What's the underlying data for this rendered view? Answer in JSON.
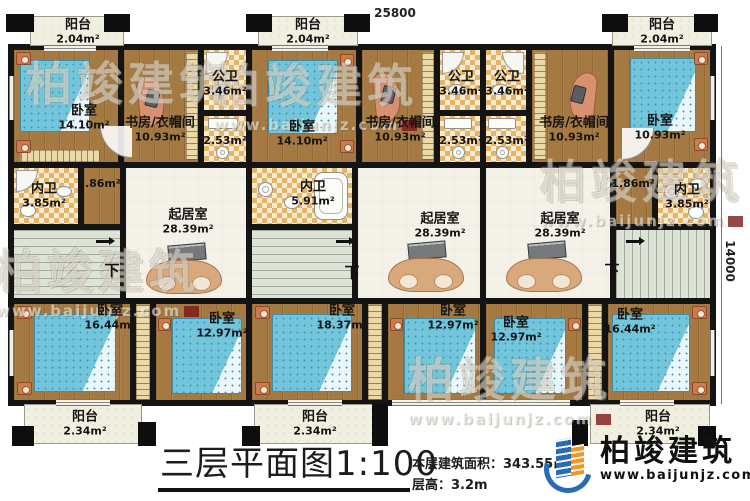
{
  "title_block": {
    "title": "三层平面图1:100",
    "area_label": "本层建筑面积：",
    "area_value": "343.55㎡",
    "height_label": "层高：",
    "height_value": "3.2m"
  },
  "logo": {
    "name": "柏竣建筑",
    "url": "www.baijunjz.com"
  },
  "watermark": {
    "text": "柏竣建筑",
    "url": "www.baijunjz.com"
  },
  "dimensions": {
    "top": {
      "text": "25800",
      "xy": [
        365,
        6
      ]
    },
    "right": {
      "text": "14000",
      "xy": [
        700,
        254
      ]
    }
  },
  "stairs_label": "下",
  "colors": {
    "wall": "#141414",
    "wood": "#a57a42",
    "bath_dark": "#e5b469",
    "bath_light": "#f6ecd2",
    "living": "#f4f2e8",
    "stair": "#dde3d7",
    "balcony": "#f1efe0",
    "bed": "#72c5da",
    "accent_blue": "#2a6cb4",
    "accent_orange": "#f7941d"
  },
  "main_block": [
    8,
    44,
    708,
    362
  ],
  "rooms": [
    {
      "name": "阳台",
      "area": "2.04m²",
      "rect": [
        30,
        16,
        94,
        30
      ],
      "type": "balcony",
      "label": [
        78,
        32
      ]
    },
    {
      "name": "阳台",
      "area": "2.04m²",
      "rect": [
        258,
        16,
        100,
        30
      ],
      "type": "balcony",
      "label": [
        308,
        32
      ]
    },
    {
      "name": "阳台",
      "area": "2.04m²",
      "rect": [
        612,
        16,
        100,
        30
      ],
      "type": "balcony",
      "label": [
        662,
        32
      ]
    },
    {
      "name": "卧室",
      "area": "14.10m²",
      "rect": [
        14,
        50,
        104,
        112
      ],
      "type": "wood",
      "label": [
        84,
        118
      ]
    },
    {
      "name": "书房/衣帽间",
      "area": "10.93m²",
      "rect": [
        124,
        50,
        74,
        112
      ],
      "type": "wood",
      "label": [
        160,
        130
      ]
    },
    {
      "name": "公卫",
      "area": "3.46m²",
      "rect": [
        204,
        50,
        42,
        60
      ],
      "type": "bath",
      "label": [
        225,
        84
      ]
    },
    {
      "name": "",
      "area": "2.53m²",
      "rect": [
        204,
        116,
        42,
        46
      ],
      "type": "bath",
      "label": [
        225,
        141
      ]
    },
    {
      "name": "内卫",
      "area": "3.85m²",
      "rect": [
        14,
        168,
        64,
        56
      ],
      "type": "bath",
      "label": [
        44,
        196
      ]
    },
    {
      "name": "",
      "area": "1.86m²",
      "rect": [
        84,
        168,
        36,
        56
      ],
      "type": "wood",
      "label": [
        99,
        184
      ]
    },
    {
      "name": "",
      "area": "",
      "rect": [
        14,
        230,
        106,
        68
      ],
      "type": "stair"
    },
    {
      "name": "起居室",
      "area": "28.39m²",
      "rect": [
        126,
        168,
        120,
        130
      ],
      "type": "living",
      "label": [
        188,
        222
      ]
    },
    {
      "name": "卧室",
      "area": "16.44m²",
      "rect": [
        14,
        304,
        116,
        96
      ],
      "type": "wood",
      "label": [
        110,
        318
      ]
    },
    {
      "name": "",
      "area": "",
      "rect": [
        136,
        304,
        14,
        96
      ],
      "type": "closet"
    },
    {
      "name": "卧室",
      "area": "12.97m²",
      "rect": [
        156,
        304,
        90,
        96
      ],
      "type": "wood",
      "label": [
        222,
        326
      ]
    },
    {
      "name": "阳台",
      "area": "2.34m²",
      "rect": [
        24,
        404,
        118,
        40
      ],
      "type": "balcony",
      "label": [
        85,
        424
      ]
    },
    {
      "name": "卧室",
      "area": "14.10m²",
      "rect": [
        252,
        50,
        104,
        112
      ],
      "type": "wood",
      "label": [
        302,
        134
      ]
    },
    {
      "name": "书房/衣帽间",
      "area": "10.93m²",
      "rect": [
        362,
        50,
        72,
        112
      ],
      "type": "wood",
      "label": [
        400,
        130
      ]
    },
    {
      "name": "公卫",
      "area": "3.46m²",
      "rect": [
        440,
        50,
        40,
        60
      ],
      "type": "bath",
      "label": [
        461,
        84
      ]
    },
    {
      "name": "",
      "area": "2.53m²",
      "rect": [
        440,
        116,
        40,
        46
      ],
      "type": "bath",
      "label": [
        461,
        141
      ]
    },
    {
      "name": "内卫",
      "area": "5.91m²",
      "rect": [
        252,
        168,
        100,
        56
      ],
      "type": "bath",
      "label": [
        313,
        194
      ]
    },
    {
      "name": "",
      "area": "",
      "rect": [
        252,
        230,
        100,
        68
      ],
      "type": "stair"
    },
    {
      "name": "起居室",
      "area": "28.39m²",
      "rect": [
        358,
        168,
        122,
        130
      ],
      "type": "living",
      "label": [
        440,
        226
      ]
    },
    {
      "name": "卧室",
      "area": "18.37m²",
      "rect": [
        252,
        304,
        110,
        96
      ],
      "type": "wood",
      "label": [
        342,
        318
      ]
    },
    {
      "name": "",
      "area": "",
      "rect": [
        368,
        304,
        14,
        96
      ],
      "type": "closet"
    },
    {
      "name": "卧室",
      "area": "12.97m²",
      "rect": [
        388,
        304,
        92,
        96
      ],
      "type": "wood",
      "label": [
        453,
        318
      ]
    },
    {
      "name": "阳台",
      "area": "2.34m²",
      "rect": [
        254,
        404,
        122,
        40
      ],
      "type": "balcony",
      "label": [
        315,
        424
      ]
    },
    {
      "name": "公卫",
      "area": "3.46m²",
      "rect": [
        486,
        50,
        40,
        60
      ],
      "type": "bath",
      "label": [
        507,
        84
      ]
    },
    {
      "name": "",
      "area": "2.53m²",
      "rect": [
        486,
        116,
        40,
        46
      ],
      "type": "bath",
      "label": [
        507,
        141
      ]
    },
    {
      "name": "书房/衣帽间",
      "area": "10.93m²",
      "rect": [
        532,
        50,
        76,
        112
      ],
      "type": "wood",
      "label": [
        574,
        130
      ]
    },
    {
      "name": "卧室",
      "area": "10.93m²",
      "rect": [
        614,
        50,
        96,
        112
      ],
      "type": "wood",
      "label": [
        660,
        128
      ]
    },
    {
      "name": "起居室",
      "area": "28.39m²",
      "rect": [
        486,
        168,
        124,
        130
      ],
      "type": "living",
      "label": [
        560,
        226
      ]
    },
    {
      "name": "",
      "area": "1.86m²",
      "rect": [
        616,
        168,
        36,
        56
      ],
      "type": "wood",
      "label": [
        633,
        184
      ]
    },
    {
      "name": "内卫",
      "area": "3.85m²",
      "rect": [
        658,
        168,
        52,
        56
      ],
      "type": "bath",
      "label": [
        687,
        197
      ]
    },
    {
      "name": "",
      "area": "",
      "rect": [
        616,
        230,
        94,
        68
      ],
      "type": "stair",
      "variant": "v"
    },
    {
      "name": "卧室",
      "area": "12.97m²",
      "rect": [
        486,
        304,
        96,
        96
      ],
      "type": "wood",
      "label": [
        516,
        330
      ]
    },
    {
      "name": "",
      "area": "",
      "rect": [
        588,
        304,
        14,
        96
      ],
      "type": "closet"
    },
    {
      "name": "卧室",
      "area": "16.44m²",
      "rect": [
        608,
        304,
        102,
        96
      ],
      "type": "wood",
      "label": [
        630,
        322
      ]
    },
    {
      "name": "阳台",
      "area": "2.34m²",
      "rect": [
        590,
        404,
        120,
        40
      ],
      "type": "balcony",
      "label": [
        658,
        424
      ]
    },
    {
      "name": "",
      "area": "",
      "rect": [
        186,
        52,
        12,
        108
      ],
      "type": "closet"
    },
    {
      "name": "",
      "area": "",
      "rect": [
        422,
        52,
        12,
        108
      ],
      "type": "closet"
    },
    {
      "name": "",
      "area": "",
      "rect": [
        534,
        52,
        12,
        108
      ],
      "type": "closet"
    },
    {
      "name": "",
      "area": "",
      "rect": [
        20,
        150,
        80,
        12
      ],
      "type": "closet",
      "variant": "h"
    }
  ],
  "furniture": [
    {
      "type": "bed",
      "rect": [
        20,
        60,
        70,
        72
      ],
      "head": "left"
    },
    {
      "type": "ns",
      "rect": [
        16,
        52,
        15,
        13
      ]
    },
    {
      "type": "ns",
      "rect": [
        16,
        140,
        15,
        13
      ]
    },
    {
      "type": "bed",
      "rect": [
        268,
        60,
        70,
        74
      ],
      "head": "right"
    },
    {
      "type": "ns",
      "rect": [
        340,
        54,
        14,
        13
      ]
    },
    {
      "type": "ns",
      "rect": [
        340,
        140,
        14,
        13
      ]
    },
    {
      "type": "bed",
      "rect": [
        630,
        58,
        66,
        74
      ],
      "head": "right"
    },
    {
      "type": "ns",
      "rect": [
        694,
        52,
        14,
        13
      ]
    },
    {
      "type": "ns",
      "rect": [
        694,
        138,
        14,
        13
      ]
    },
    {
      "type": "bed",
      "rect": [
        34,
        314,
        82,
        78
      ],
      "head": "left"
    },
    {
      "type": "ns",
      "rect": [
        17,
        306,
        15,
        13
      ]
    },
    {
      "type": "ns",
      "rect": [
        17,
        382,
        15,
        13
      ]
    },
    {
      "type": "bed",
      "rect": [
        172,
        318,
        70,
        76
      ],
      "head": "left"
    },
    {
      "type": "ns",
      "rect": [
        158,
        318,
        13,
        13
      ]
    },
    {
      "type": "bed",
      "rect": [
        272,
        314,
        80,
        78
      ],
      "head": "left"
    },
    {
      "type": "ns",
      "rect": [
        255,
        306,
        15,
        13
      ]
    },
    {
      "type": "ns",
      "rect": [
        255,
        382,
        15,
        13
      ]
    },
    {
      "type": "bed",
      "rect": [
        404,
        318,
        72,
        76
      ],
      "head": "left"
    },
    {
      "type": "ns",
      "rect": [
        390,
        318,
        13,
        13
      ]
    },
    {
      "type": "bed",
      "rect": [
        494,
        318,
        72,
        76
      ],
      "head": "right"
    },
    {
      "type": "ns",
      "rect": [
        568,
        318,
        13,
        13
      ]
    },
    {
      "type": "bed",
      "rect": [
        612,
        314,
        78,
        78
      ],
      "head": "right"
    },
    {
      "type": "ns",
      "rect": [
        692,
        306,
        15,
        13
      ]
    },
    {
      "type": "ns",
      "rect": [
        692,
        382,
        15,
        13
      ]
    },
    {
      "type": "desk",
      "rect": [
        138,
        76,
        26,
        50
      ]
    },
    {
      "type": "monitor",
      "rect": [
        146,
        90,
        13,
        17
      ]
    },
    {
      "type": "desk",
      "rect": [
        374,
        72,
        26,
        50
      ]
    },
    {
      "type": "monitor",
      "rect": [
        382,
        86,
        13,
        17
      ]
    },
    {
      "type": "desk",
      "rect": [
        570,
        72,
        26,
        50
      ],
      "flip": true
    },
    {
      "type": "monitor",
      "rect": [
        572,
        86,
        13,
        17
      ]
    },
    {
      "type": "tv",
      "rect": [
        168,
        244,
        38,
        17
      ]
    },
    {
      "type": "sofa",
      "rect": [
        146,
        260,
        76,
        34
      ]
    },
    {
      "type": "tv",
      "rect": [
        408,
        242,
        38,
        17
      ]
    },
    {
      "type": "sofa",
      "rect": [
        388,
        258,
        76,
        34
      ]
    },
    {
      "type": "tv",
      "rect": [
        528,
        242,
        38,
        17
      ]
    },
    {
      "type": "sofa",
      "rect": [
        506,
        258,
        76,
        34
      ]
    },
    {
      "type": "shower",
      "rect": [
        206,
        52,
        22,
        22
      ],
      "corner": "tl"
    },
    {
      "type": "sink",
      "rect": [
        212,
        84,
        18,
        12
      ]
    },
    {
      "type": "sinkrect",
      "rect": [
        208,
        118,
        30,
        11
      ]
    },
    {
      "type": "basin",
      "rect": [
        216,
        146,
        13,
        13
      ]
    },
    {
      "type": "shower",
      "rect": [
        442,
        52,
        22,
        22
      ],
      "corner": "tl"
    },
    {
      "type": "sink",
      "rect": [
        448,
        84,
        17,
        11
      ]
    },
    {
      "type": "sinkrect",
      "rect": [
        444,
        118,
        28,
        11
      ]
    },
    {
      "type": "basin",
      "rect": [
        452,
        146,
        13,
        13
      ]
    },
    {
      "type": "shower",
      "rect": [
        502,
        52,
        22,
        22
      ],
      "corner": "tr"
    },
    {
      "type": "sink",
      "rect": [
        492,
        84,
        17,
        11
      ]
    },
    {
      "type": "sinkrect",
      "rect": [
        488,
        118,
        28,
        11
      ]
    },
    {
      "type": "basin",
      "rect": [
        496,
        146,
        13,
        13
      ]
    },
    {
      "type": "shower",
      "rect": [
        16,
        170,
        22,
        22
      ],
      "corner": "tl"
    },
    {
      "type": "toilet",
      "rect": [
        20,
        204,
        16,
        13
      ]
    },
    {
      "type": "sink",
      "rect": [
        56,
        186,
        16,
        11
      ]
    },
    {
      "type": "tub",
      "rect": [
        314,
        172,
        34,
        48
      ]
    },
    {
      "type": "basin",
      "rect": [
        258,
        182,
        15,
        15
      ]
    },
    {
      "type": "toilet",
      "rect": [
        284,
        196,
        16,
        13
      ]
    },
    {
      "type": "basin",
      "rect": [
        664,
        184,
        15,
        15
      ]
    },
    {
      "type": "toilet",
      "rect": [
        688,
        206,
        16,
        13
      ]
    },
    {
      "type": "sink",
      "rect": [
        690,
        178,
        16,
        11
      ]
    },
    {
      "type": "arc",
      "rect": [
        100,
        126,
        32,
        32
      ],
      "corner": "bl"
    },
    {
      "type": "arc",
      "rect": [
        622,
        128,
        32,
        32
      ],
      "corner": "br"
    },
    {
      "type": "arrow",
      "rect": [
        96,
        240,
        14,
        3
      ]
    },
    {
      "type": "arrow",
      "rect": [
        336,
        240,
        14,
        3
      ]
    },
    {
      "type": "arrow",
      "rect": [
        626,
        240,
        14,
        3
      ]
    }
  ],
  "stair_marks": [
    {
      "xy": [
        112,
        270
      ]
    },
    {
      "xy": [
        352,
        272
      ]
    },
    {
      "xy": [
        612,
        270
      ]
    }
  ],
  "windows": [
    [
      44,
      45,
      52,
      7,
      "h"
    ],
    [
      272,
      45,
      56,
      7,
      "h"
    ],
    [
      634,
      45,
      56,
      7,
      "h"
    ],
    [
      392,
      399,
      178,
      7,
      "h"
    ],
    [
      56,
      399,
      54,
      7,
      "h"
    ],
    [
      288,
      399,
      54,
      7,
      "h"
    ],
    [
      620,
      399,
      54,
      7,
      "h"
    ],
    [
      9,
      76,
      5,
      44,
      "v"
    ],
    [
      9,
      330,
      5,
      46,
      "v"
    ],
    [
      710,
      76,
      5,
      44,
      "v"
    ],
    [
      710,
      330,
      5,
      46,
      "v"
    ]
  ],
  "piers": [
    [
      6,
      14,
      28,
      18
    ],
    [
      104,
      14,
      26,
      18
    ],
    [
      246,
      14,
      26,
      18
    ],
    [
      344,
      14,
      26,
      18
    ],
    [
      602,
      14,
      26,
      18
    ],
    [
      694,
      14,
      24,
      18
    ],
    [
      12,
      426,
      22,
      20
    ],
    [
      138,
      422,
      18,
      24
    ],
    [
      242,
      426,
      18,
      20
    ],
    [
      372,
      404,
      16,
      42
    ],
    [
      572,
      420,
      16,
      26
    ],
    [
      698,
      426,
      18,
      20
    ]
  ],
  "watermarks": [
    {
      "x": 26,
      "y": 48,
      "url": false
    },
    {
      "x": 214,
      "y": 50,
      "url": true
    },
    {
      "x": -4,
      "y": 236,
      "url": true
    },
    {
      "x": 540,
      "y": 146,
      "url": true
    },
    {
      "x": 408,
      "y": 344,
      "url": true
    }
  ]
}
